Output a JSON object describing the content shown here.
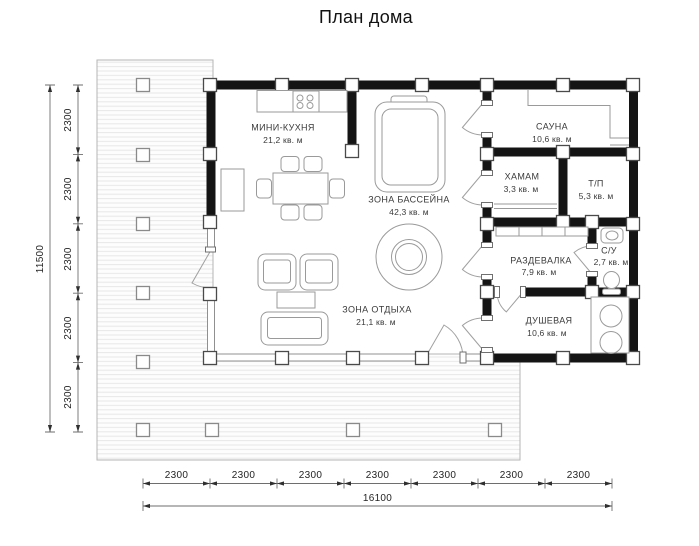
{
  "title": "План дома",
  "rooms": {
    "kitchen": {
      "name": "МИНИ-КУХНЯ",
      "area": "21,2 кв. м"
    },
    "pool": {
      "name": "ЗОНА БАССЕЙНА",
      "area": "42,3 кв. м"
    },
    "lounge": {
      "name": "ЗОНА ОТДЫХА",
      "area": "21,1 кв. м"
    },
    "sauna": {
      "name": "САУНА",
      "area": "10,6 кв. м"
    },
    "hamam": {
      "name": "ХАМАМ",
      "area": "3,3 кв. м"
    },
    "tp": {
      "name": "Т/П",
      "area": "5,3 кв. м"
    },
    "dressing": {
      "name": "РАЗДЕВАЛКА",
      "area": "7,9 кв. м"
    },
    "wc": {
      "name": "С/У",
      "area": "2,7 кв. м"
    },
    "shower": {
      "name": "ДУШЕВАЯ",
      "area": "10,6 кв. м"
    }
  },
  "dimensions": {
    "left": {
      "segments": [
        "2300",
        "2300",
        "2300",
        "2300",
        "2300"
      ],
      "total": "11500"
    },
    "bottom": {
      "segments": [
        "2300",
        "2300",
        "2300",
        "2300",
        "2300",
        "2300",
        "2300"
      ],
      "total": "16100"
    }
  },
  "colors": {
    "wall": "#141414",
    "furniture_line": "#9a9a9a",
    "dimension": "#6e6e6e"
  }
}
